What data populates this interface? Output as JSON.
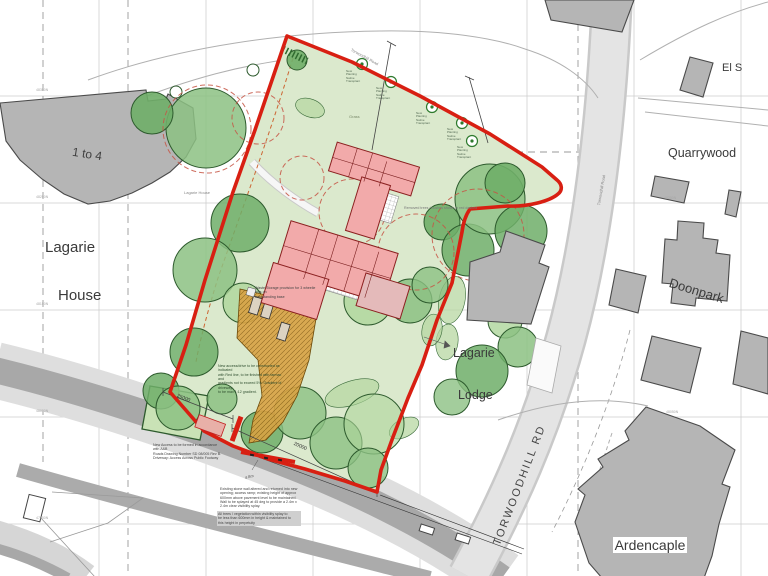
{
  "map_labels": {
    "one_to_four": "1 to 4",
    "lagarie_house_line1": "Lagarie",
    "lagarie_house_line2": "House",
    "lagarie_house_small": "Lagarie House",
    "lagarie_lodge_line1": "Lagarie",
    "lagarie_lodge_line2": "Lodge",
    "ardencaple_line1": "Ardencaple",
    "ardencaple_line2": "Hotel",
    "quarrywood": "Quarrywood",
    "doonpark": "Doonpark",
    "el_sub_station": "El S",
    "torwoodhill_rd": "TORWOODHILL RD",
    "torwoodhill_road_small": "Torwoodhill Road",
    "grass": "Grass"
  },
  "survey_grid": {
    "left_labels": [
      "48350N",
      "48250N",
      "48150N",
      "48050N",
      "47950N"
    ],
    "right_labels": [
      "48250N",
      "48050N"
    ]
  },
  "dimensions": {
    "d25000": "25000",
    "d20000": "20000",
    "wall_gap": "4.8m"
  },
  "notes": {
    "removed_trees": "Removed trees / bushes shown in red dashed",
    "waste": "Waste Storage provision for 3 wheelie bins on\nhardstanding base",
    "access_drive": "New access/drive to be constructed as indicated\nwith Red line, to be finished with tarmac and\ngradients not to exceed 5%. Gradient of driveway\nto be max 1:12 gradient.",
    "new_access": "New Access to be formed in accordance with A&B\nRoads Drawing Number SD 08/005 Rev B.\nDriveway: Access Across Public Footway",
    "stone_wall": "Existing stone wall altered and returned into new\nopening; access ramp; existing height of approx\n600mm above pavement level to be maintained.\nWall to be splayed at 45 deg to provide a 2.4m x\n2.4m clear visibility splay.",
    "visibility": "All trees / vegetation within visibility splay to\nbe less than 600mm in height & maintained to\nthis height in perpetuity"
  },
  "planting": {
    "new_tree_tag": "New\nPlanting\nNative\nTransplant"
  },
  "colors": {
    "boundary_red": "#d81f12",
    "site_green": "#dbe9cd",
    "tree_green": "#7fb877",
    "shrub_green": "#b7d7a2",
    "drive_orange": "#d8a243",
    "building_pink": "#f2aaaa",
    "building_gray": "#b5b5b5",
    "road_dark": "#a8a8a8",
    "road_light": "#e2e2e2",
    "removed_red": "#c65545"
  }
}
